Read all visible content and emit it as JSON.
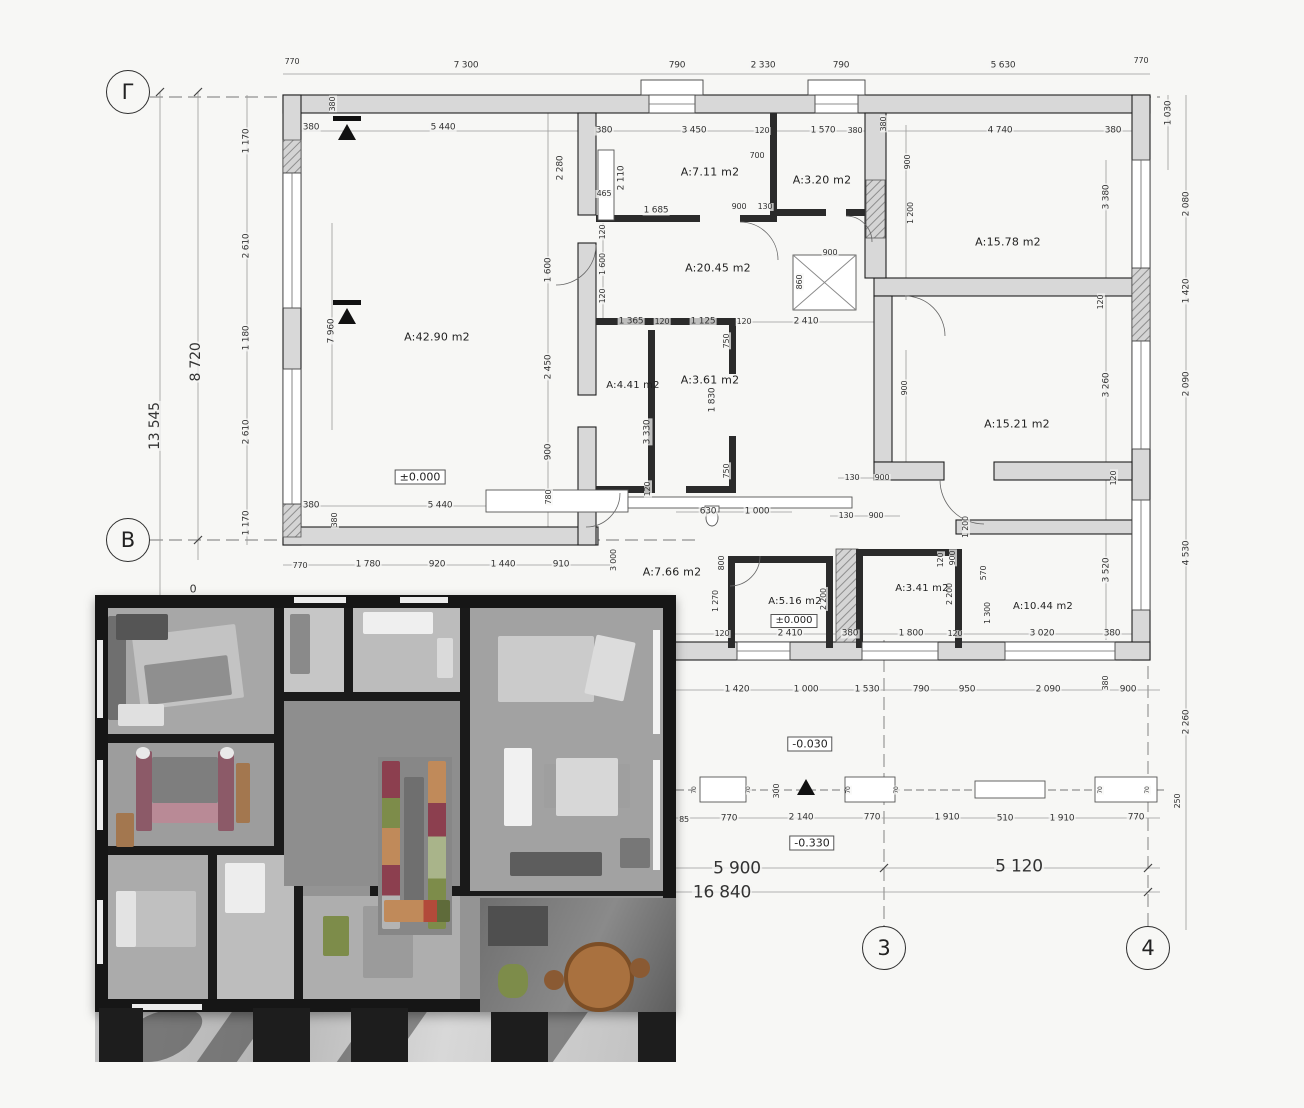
{
  "colors": {
    "wall_fill": "#d8d8d8",
    "int_wall": "#2b2b2b",
    "line": "#9a9a9a",
    "render_wall": "#161616",
    "table_wood": "#a9713f",
    "bed_maroon": "#8c5a68",
    "closet_green": "#7d8c4a",
    "closet_tan": "#c08a5a"
  },
  "axis_bubbles": [
    {
      "t": "Г",
      "x": 128,
      "y": 92
    },
    {
      "t": "В",
      "x": 128,
      "y": 540
    },
    {
      "t": "3",
      "x": 884,
      "y": 948
    },
    {
      "t": "4",
      "x": 1148,
      "y": 948
    }
  ],
  "room_labels": [
    {
      "t": "A:42.90 m2",
      "x": 437,
      "y": 337
    },
    {
      "t": "A:7.11 m2",
      "x": 710,
      "y": 172
    },
    {
      "t": "A:3.20 m2",
      "x": 822,
      "y": 180
    },
    {
      "t": "A:20.45 m2",
      "x": 718,
      "y": 268
    },
    {
      "t": "A:15.78 m2",
      "x": 1008,
      "y": 242
    },
    {
      "t": "A:15.21 m2",
      "x": 1017,
      "y": 424
    },
    {
      "t": "A:4.41 m2",
      "x": 633,
      "y": 386,
      "s": 10
    },
    {
      "t": "A:3.61 m2",
      "x": 710,
      "y": 380
    },
    {
      "t": "A:7.66 m2",
      "x": 672,
      "y": 572
    },
    {
      "t": "A:5.16 m2",
      "x": 795,
      "y": 602,
      "s": 10
    },
    {
      "t": "A:3.41 m2",
      "x": 922,
      "y": 589,
      "s": 10
    },
    {
      "t": "A:10.44 m2",
      "x": 1043,
      "y": 607,
      "s": 10
    }
  ],
  "elevation_marks": [
    {
      "t": "±0.000",
      "x": 420,
      "y": 477
    },
    {
      "t": "±0.000",
      "x": 794,
      "y": 621,
      "s": 10
    },
    {
      "t": "-0.030",
      "x": 810,
      "y": 744
    },
    {
      "t": "-0.330",
      "x": 812,
      "y": 843
    }
  ],
  "dim_labels": [
    {
      "t": "770",
      "x": 292,
      "y": 62,
      "s": 8
    },
    {
      "t": "7 300",
      "x": 466,
      "y": 66
    },
    {
      "t": "790",
      "x": 677,
      "y": 66
    },
    {
      "t": "2 330",
      "x": 763,
      "y": 66
    },
    {
      "t": "790",
      "x": 841,
      "y": 66
    },
    {
      "t": "5 630",
      "x": 1003,
      "y": 66
    },
    {
      "t": "770",
      "x": 1141,
      "y": 61,
      "s": 8
    },
    {
      "t": "380",
      "x": 311,
      "y": 128
    },
    {
      "t": "5 440",
      "x": 443,
      "y": 128
    },
    {
      "t": "380",
      "x": 333,
      "y": 104,
      "r": -90,
      "s": 8
    },
    {
      "t": "380",
      "x": 604,
      "y": 131
    },
    {
      "t": "3 450",
      "x": 694,
      "y": 131
    },
    {
      "t": "120",
      "x": 762,
      "y": 131,
      "s": 8
    },
    {
      "t": "1 570",
      "x": 823,
      "y": 131
    },
    {
      "t": "380",
      "x": 855,
      "y": 131,
      "s": 8
    },
    {
      "t": "380",
      "x": 884,
      "y": 124,
      "r": -90,
      "s": 8
    },
    {
      "t": "4 740",
      "x": 1000,
      "y": 131
    },
    {
      "t": "380",
      "x": 1113,
      "y": 131
    },
    {
      "t": "700",
      "x": 757,
      "y": 156,
      "s": 8
    },
    {
      "t": "2 110",
      "x": 622,
      "y": 178,
      "r": -90
    },
    {
      "t": "465",
      "x": 604,
      "y": 194,
      "s": 8
    },
    {
      "t": "1 685",
      "x": 656,
      "y": 211
    },
    {
      "t": "900",
      "x": 739,
      "y": 207,
      "s": 8
    },
    {
      "t": "130",
      "x": 765,
      "y": 207,
      "s": 8
    },
    {
      "t": "2 280",
      "x": 561,
      "y": 168,
      "r": -90
    },
    {
      "t": "900",
      "x": 908,
      "y": 162,
      "r": -90,
      "s": 8
    },
    {
      "t": "1 200",
      "x": 911,
      "y": 213,
      "r": -90,
      "s": 8
    },
    {
      "t": "900",
      "x": 905,
      "y": 388,
      "r": -90,
      "s": 8
    },
    {
      "t": "3 380",
      "x": 1107,
      "y": 197,
      "r": -90
    },
    {
      "t": "120",
      "x": 1101,
      "y": 302,
      "r": -90,
      "s": 8
    },
    {
      "t": "3 260",
      "x": 1107,
      "y": 385,
      "r": -90
    },
    {
      "t": "1 030",
      "x": 1169,
      "y": 113,
      "r": -90
    },
    {
      "t": "2 080",
      "x": 1187,
      "y": 204,
      "r": -90
    },
    {
      "t": "1 420",
      "x": 1187,
      "y": 291,
      "r": -90
    },
    {
      "t": "2 090",
      "x": 1187,
      "y": 384,
      "r": -90
    },
    {
      "t": "4 530",
      "x": 1187,
      "y": 553,
      "r": -90
    },
    {
      "t": "2 260",
      "x": 1187,
      "y": 722,
      "r": -90
    },
    {
      "t": "250",
      "x": 1178,
      "y": 801,
      "r": -90,
      "s": 8
    },
    {
      "t": "13 545",
      "x": 155,
      "y": 426,
      "r": -90,
      "s": 14
    },
    {
      "t": "8 720",
      "x": 196,
      "y": 362,
      "r": -90,
      "s": 14
    },
    {
      "t": "0",
      "x": 193,
      "y": 589,
      "s": 11
    },
    {
      "t": "1 170",
      "x": 247,
      "y": 141,
      "r": -90
    },
    {
      "t": "2 610",
      "x": 247,
      "y": 246,
      "r": -90
    },
    {
      "t": "1 180",
      "x": 247,
      "y": 338,
      "r": -90
    },
    {
      "t": "2 610",
      "x": 247,
      "y": 432,
      "r": -90
    },
    {
      "t": "1 170",
      "x": 247,
      "y": 523,
      "r": -90
    },
    {
      "t": "7 960",
      "x": 332,
      "y": 331,
      "r": -90
    },
    {
      "t": "380",
      "x": 311,
      "y": 506
    },
    {
      "t": "5 440",
      "x": 440,
      "y": 506
    },
    {
      "t": "380",
      "x": 335,
      "y": 520,
      "r": -90,
      "s": 8
    },
    {
      "t": "770",
      "x": 300,
      "y": 566,
      "s": 8
    },
    {
      "t": "1 780",
      "x": 368,
      "y": 565
    },
    {
      "t": "920",
      "x": 437,
      "y": 565
    },
    {
      "t": "1 440",
      "x": 503,
      "y": 565
    },
    {
      "t": "910",
      "x": 561,
      "y": 565
    },
    {
      "t": "3 000",
      "x": 614,
      "y": 560,
      "r": -90,
      "s": 8
    },
    {
      "t": "1 600",
      "x": 549,
      "y": 270,
      "r": -90
    },
    {
      "t": "2 450",
      "x": 549,
      "y": 367,
      "r": -90
    },
    {
      "t": "900",
      "x": 549,
      "y": 452,
      "r": -90
    },
    {
      "t": "780",
      "x": 549,
      "y": 497,
      "r": -90,
      "s": 8
    },
    {
      "t": "120",
      "x": 603,
      "y": 232,
      "r": -90,
      "s": 8
    },
    {
      "t": "1 600",
      "x": 603,
      "y": 264,
      "r": -90,
      "s": 8
    },
    {
      "t": "120",
      "x": 603,
      "y": 296,
      "r": -90,
      "s": 8
    },
    {
      "t": "1 365",
      "x": 631,
      "y": 322
    },
    {
      "t": "120",
      "x": 662,
      "y": 322,
      "s": 8
    },
    {
      "t": "1 125",
      "x": 703,
      "y": 322
    },
    {
      "t": "120",
      "x": 744,
      "y": 322,
      "s": 8
    },
    {
      "t": "2 410",
      "x": 806,
      "y": 322
    },
    {
      "t": "750",
      "x": 727,
      "y": 341,
      "r": -90,
      "s": 8
    },
    {
      "t": "1 830",
      "x": 713,
      "y": 400,
      "r": -90
    },
    {
      "t": "750",
      "x": 727,
      "y": 471,
      "r": -90,
      "s": 8
    },
    {
      "t": "3 330",
      "x": 648,
      "y": 432,
      "r": -90
    },
    {
      "t": "120",
      "x": 648,
      "y": 489,
      "r": -90,
      "s": 8
    },
    {
      "t": "900",
      "x": 830,
      "y": 253,
      "s": 8
    },
    {
      "t": "860",
      "x": 800,
      "y": 282,
      "r": -90,
      "s": 8
    },
    {
      "t": "630",
      "x": 708,
      "y": 512
    },
    {
      "t": "1 000",
      "x": 757,
      "y": 512
    },
    {
      "t": "130",
      "x": 852,
      "y": 478,
      "s": 8
    },
    {
      "t": "900",
      "x": 882,
      "y": 478,
      "s": 8
    },
    {
      "t": "130",
      "x": 846,
      "y": 516,
      "s": 8
    },
    {
      "t": "900",
      "x": 876,
      "y": 516,
      "s": 8
    },
    {
      "t": "1 200",
      "x": 966,
      "y": 527,
      "r": -90,
      "s": 8
    },
    {
      "t": "900",
      "x": 953,
      "y": 558,
      "r": -90,
      "s": 8
    },
    {
      "t": "570",
      "x": 984,
      "y": 573,
      "r": -90,
      "s": 8
    },
    {
      "t": "1 300",
      "x": 988,
      "y": 613,
      "r": -90,
      "s": 8
    },
    {
      "t": "120",
      "x": 941,
      "y": 560,
      "r": -90,
      "s": 8
    },
    {
      "t": "800",
      "x": 722,
      "y": 563,
      "r": -90,
      "s": 8
    },
    {
      "t": "1 270",
      "x": 716,
      "y": 601,
      "r": -90,
      "s": 8
    },
    {
      "t": "2 200",
      "x": 824,
      "y": 599,
      "r": -90,
      "s": 8
    },
    {
      "t": "2 200",
      "x": 950,
      "y": 594,
      "r": -90,
      "s": 8
    },
    {
      "t": "120",
      "x": 1114,
      "y": 478,
      "r": -90,
      "s": 8
    },
    {
      "t": "3 520",
      "x": 1107,
      "y": 570,
      "r": -90
    },
    {
      "t": "120",
      "x": 722,
      "y": 634,
      "s": 8
    },
    {
      "t": "2 410",
      "x": 790,
      "y": 634
    },
    {
      "t": "380",
      "x": 850,
      "y": 634
    },
    {
      "t": "1 800",
      "x": 911,
      "y": 634
    },
    {
      "t": "120",
      "x": 955,
      "y": 634,
      "s": 8
    },
    {
      "t": "3 020",
      "x": 1042,
      "y": 634
    },
    {
      "t": "380",
      "x": 1112,
      "y": 634
    },
    {
      "t": "1 420",
      "x": 737,
      "y": 690
    },
    {
      "t": "1 000",
      "x": 806,
      "y": 690
    },
    {
      "t": "1 530",
      "x": 867,
      "y": 690
    },
    {
      "t": "790",
      "x": 921,
      "y": 690
    },
    {
      "t": "950",
      "x": 967,
      "y": 690
    },
    {
      "t": "2 090",
      "x": 1048,
      "y": 690
    },
    {
      "t": "380",
      "x": 1106,
      "y": 683,
      "r": -90,
      "s": 8
    },
    {
      "t": "900",
      "x": 1128,
      "y": 690
    },
    {
      "t": "85",
      "x": 684,
      "y": 820,
      "s": 8
    },
    {
      "t": "770",
      "x": 729,
      "y": 819
    },
    {
      "t": "2 140",
      "x": 801,
      "y": 818
    },
    {
      "t": "770",
      "x": 872,
      "y": 818
    },
    {
      "t": "1 910",
      "x": 947,
      "y": 818
    },
    {
      "t": "510",
      "x": 1005,
      "y": 819
    },
    {
      "t": "1 910",
      "x": 1062,
      "y": 819
    },
    {
      "t": "770",
      "x": 1136,
      "y": 818
    },
    {
      "t": "300",
      "x": 777,
      "y": 791,
      "r": -90,
      "s": 8
    },
    {
      "t": "70",
      "x": 695,
      "y": 790,
      "r": -90,
      "s": 6
    },
    {
      "t": "70",
      "x": 749,
      "y": 790,
      "r": -90,
      "s": 6
    },
    {
      "t": "70",
      "x": 849,
      "y": 790,
      "r": -90,
      "s": 6
    },
    {
      "t": "70",
      "x": 897,
      "y": 790,
      "r": -90,
      "s": 6
    },
    {
      "t": "70",
      "x": 1101,
      "y": 790,
      "r": -90,
      "s": 6
    },
    {
      "t": "70",
      "x": 1148,
      "y": 790,
      "r": -90,
      "s": 6
    },
    {
      "t": "5 900",
      "x": 737,
      "y": 869,
      "s": 17
    },
    {
      "t": "5 120",
      "x": 1019,
      "y": 867,
      "s": 17
    },
    {
      "t": "16 840",
      "x": 722,
      "y": 893,
      "s": 17
    }
  ]
}
